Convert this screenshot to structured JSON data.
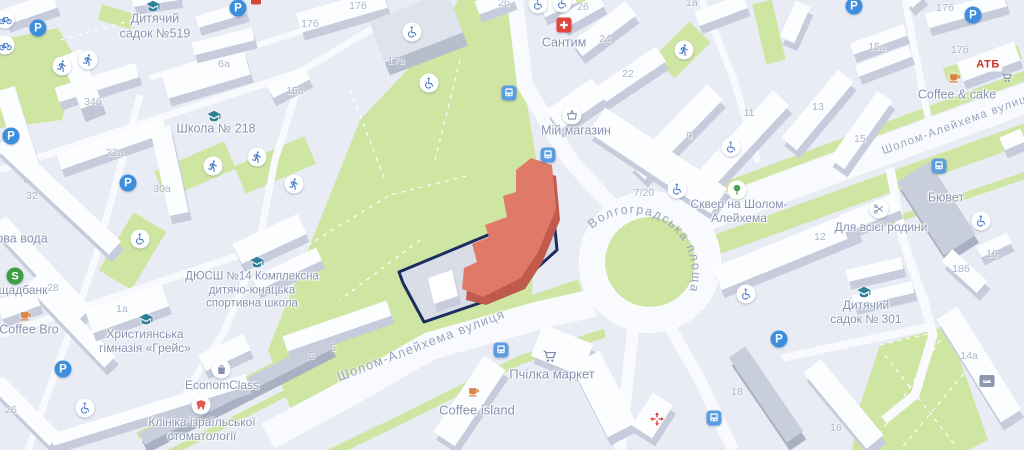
{
  "map": {
    "colors": {
      "background": "#e9ecf4",
      "green": "#cfe6a2",
      "road": "#f8fafd",
      "building_top": "#fcfdff",
      "building_side": "#c6ccdb",
      "highlight_building": "#df7a68",
      "highlight_building_side": "#bf5a4d",
      "selection_outline": "#1c2d5f",
      "poi_text": "#8793b3",
      "street_text": "#9aa4c1",
      "number_text": "#adb5ca",
      "parking_blue": "#3e8ede",
      "icon_blue": "#4f7fc9",
      "poi_green": "#4da052",
      "poi_orange": "#dd8544",
      "poi_red": "#e3453c",
      "atb_red": "#cf2e26"
    },
    "streets": [
      {
        "name": "Шолом-Алейхема вулиця",
        "x": 421,
        "y": 345,
        "angle": -21
      },
      {
        "name": "Шолом-Алейхема вулиця",
        "x": 958,
        "y": 124,
        "angle": -20
      },
      {
        "name": "Волгоградська площа"
      }
    ],
    "pois": [
      {
        "lines": [
          "Дитячий",
          "садок №519"
        ],
        "x": 155,
        "y": 26,
        "size": 12.5,
        "icon": "school",
        "ix": 153,
        "iy": 6
      },
      {
        "lines": [
          "Школа № 218"
        ],
        "x": 216,
        "y": 129,
        "size": 12.5,
        "icon": "school",
        "ix": 214,
        "iy": 116
      },
      {
        "lines": [
          "ова вода"
        ],
        "x": 22,
        "y": 239,
        "size": 12.5
      },
      {
        "lines": [
          "щадбанк"
        ],
        "x": 23,
        "y": 290,
        "size": 12,
        "icon": "bank",
        "ix": 15,
        "iy": 276
      },
      {
        "lines": [
          "Coffee Bro"
        ],
        "x": 29,
        "y": 330,
        "size": 12.5,
        "icon": "coffee",
        "ix": 26,
        "iy": 315
      },
      {
        "lines": [
          "Християнська",
          "гімназія «Грейс»"
        ],
        "x": 145,
        "y": 341,
        "size": 12,
        "icon": "school",
        "ix": 146,
        "iy": 319
      },
      {
        "lines": [
          "ДЮСШ №14 Комплексна",
          "дитячо-юнацька",
          "спортивна школа"
        ],
        "x": 252,
        "y": 291,
        "size": 11.5,
        "icon": "school",
        "ix": 257,
        "iy": 262
      },
      {
        "lines": [
          "EconomClass"
        ],
        "x": 222,
        "y": 385,
        "size": 12,
        "icon": "bag",
        "ix": 221,
        "iy": 369
      },
      {
        "lines": [
          "Клініка ізраїльської",
          "стоматології"
        ],
        "x": 202,
        "y": 429,
        "size": 12,
        "icon": "tooth",
        "ix": 201,
        "iy": 405
      },
      {
        "lines": [
          "Сантим"
        ],
        "x": 564,
        "y": 43,
        "size": 12.5,
        "icon": "pharmacy",
        "ix": 564,
        "iy": 25
      },
      {
        "lines": [
          "Мій магазин"
        ],
        "x": 576,
        "y": 131,
        "size": 12.5,
        "icon": "basket",
        "ix": 572,
        "iy": 115
      },
      {
        "lines": [
          "Сквер на Шолом-",
          "Алейхема"
        ],
        "x": 739,
        "y": 211,
        "size": 12,
        "icon": "tree",
        "ix": 737,
        "iy": 190
      },
      {
        "lines": [
          "Coffee & cake"
        ],
        "x": 957,
        "y": 95,
        "size": 12.5,
        "icon": "coffee",
        "ix": 955,
        "iy": 77
      },
      {
        "lines": [
          "АТБ"
        ],
        "x": 988,
        "y": 65,
        "size": 11,
        "logo": true
      },
      {
        "lines": [
          "Бювет"
        ],
        "x": 946,
        "y": 198,
        "size": 12.5
      },
      {
        "lines": [
          "Для всієї родини"
        ],
        "x": 881,
        "y": 227,
        "size": 12,
        "icon": "scissors",
        "ix": 879,
        "iy": 209
      },
      {
        "lines": [
          "Дитячий",
          "садок № 301"
        ],
        "x": 866,
        "y": 312,
        "size": 12,
        "icon": "school",
        "ix": 864,
        "iy": 292
      },
      {
        "lines": [
          "Пчілка маркет"
        ],
        "x": 552,
        "y": 374,
        "size": 13,
        "icon": "cart",
        "ix": 550,
        "iy": 357
      },
      {
        "lines": [
          "Coffee island"
        ],
        "x": 477,
        "y": 410,
        "size": 13,
        "icon": "coffee",
        "ix": 474,
        "iy": 391
      }
    ],
    "icons": [
      {
        "type": "parking",
        "x": 11,
        "y": 136
      },
      {
        "type": "parking",
        "x": 38,
        "y": 28
      },
      {
        "type": "parking",
        "x": 238,
        "y": 8
      },
      {
        "type": "parking",
        "x": 128,
        "y": 183
      },
      {
        "type": "parking",
        "x": 63,
        "y": 369
      },
      {
        "type": "parking",
        "x": 854,
        "y": 6
      },
      {
        "type": "parking",
        "x": 973,
        "y": 15
      },
      {
        "type": "parking",
        "x": 779,
        "y": 339
      },
      {
        "type": "running",
        "x": 62,
        "y": 66
      },
      {
        "type": "running",
        "x": 88,
        "y": 60
      },
      {
        "type": "running",
        "x": 213,
        "y": 166
      },
      {
        "type": "running",
        "x": 257,
        "y": 157
      },
      {
        "type": "running",
        "x": 294,
        "y": 184
      },
      {
        "type": "running",
        "x": 684,
        "y": 50
      },
      {
        "type": "wheelchair",
        "x": 140,
        "y": 239
      },
      {
        "type": "wheelchair",
        "x": 85,
        "y": 408
      },
      {
        "type": "wheelchair",
        "x": 412,
        "y": 32
      },
      {
        "type": "wheelchair",
        "x": 429,
        "y": 83
      },
      {
        "type": "wheelchair",
        "x": 538,
        "y": 4
      },
      {
        "type": "wheelchair",
        "x": 562,
        "y": 3
      },
      {
        "type": "wheelchair",
        "x": 677,
        "y": 189
      },
      {
        "type": "wheelchair",
        "x": 731,
        "y": 147
      },
      {
        "type": "wheelchair",
        "x": 746,
        "y": 294
      },
      {
        "type": "wheelchair",
        "x": 981,
        "y": 221
      },
      {
        "type": "bicycle",
        "x": 5,
        "y": 19
      },
      {
        "type": "bicycle",
        "x": 5,
        "y": 45
      },
      {
        "type": "bus",
        "x": 509,
        "y": 93
      },
      {
        "type": "bus",
        "x": 548,
        "y": 155
      },
      {
        "type": "bus",
        "x": 939,
        "y": 166
      },
      {
        "type": "bus",
        "x": 501,
        "y": 350
      },
      {
        "type": "bus",
        "x": 714,
        "y": 418
      },
      {
        "type": "cart-small",
        "x": 1007,
        "y": 78
      },
      {
        "type": "medcross",
        "x": 657,
        "y": 419
      },
      {
        "type": "hotel",
        "x": 987,
        "y": 381
      },
      {
        "type": "redchip",
        "x": 256,
        "y": 1
      }
    ],
    "building_numbers": [
      {
        "t": "6а",
        "x": 224,
        "y": 64
      },
      {
        "t": "15а",
        "x": 295,
        "y": 91
      },
      {
        "t": "34б",
        "x": 93,
        "y": 102
      },
      {
        "t": "17б",
        "x": 310,
        "y": 24
      },
      {
        "t": "17б",
        "x": 358,
        "y": 6
      },
      {
        "t": "17в",
        "x": 396,
        "y": 61
      },
      {
        "t": "2б",
        "x": 504,
        "y": 3
      },
      {
        "t": "2б",
        "x": 583,
        "y": 7
      },
      {
        "t": "1а",
        "x": 692,
        "y": 3
      },
      {
        "t": "24",
        "x": 605,
        "y": 39
      },
      {
        "t": "22",
        "x": 628,
        "y": 74
      },
      {
        "t": "9",
        "x": 689,
        "y": 136
      },
      {
        "t": "11",
        "x": 749,
        "y": 113
      },
      {
        "t": "13",
        "x": 818,
        "y": 107
      },
      {
        "t": "15",
        "x": 860,
        "y": 139
      },
      {
        "t": "15а",
        "x": 877,
        "y": 47
      },
      {
        "t": "17б",
        "x": 945,
        "y": 8
      },
      {
        "t": "17б",
        "x": 960,
        "y": 50
      },
      {
        "t": "32а",
        "x": 115,
        "y": 153
      },
      {
        "t": "32",
        "x": 32,
        "y": 196
      },
      {
        "t": "30а",
        "x": 162,
        "y": 189
      },
      {
        "t": "28",
        "x": 53,
        "y": 288
      },
      {
        "t": "26",
        "x": 11,
        "y": 410
      },
      {
        "t": "1а",
        "x": 122,
        "y": 309
      },
      {
        "t": "5",
        "x": 312,
        "y": 356
      },
      {
        "t": "5",
        "x": 333,
        "y": 348
      },
      {
        "t": "7/20",
        "x": 644,
        "y": 193
      },
      {
        "t": "12",
        "x": 820,
        "y": 237
      },
      {
        "t": "16",
        "x": 992,
        "y": 254
      },
      {
        "t": "18б",
        "x": 961,
        "y": 269
      },
      {
        "t": "16",
        "x": 836,
        "y": 428
      },
      {
        "t": "18",
        "x": 737,
        "y": 392
      },
      {
        "t": "14а",
        "x": 969,
        "y": 356
      }
    ]
  }
}
